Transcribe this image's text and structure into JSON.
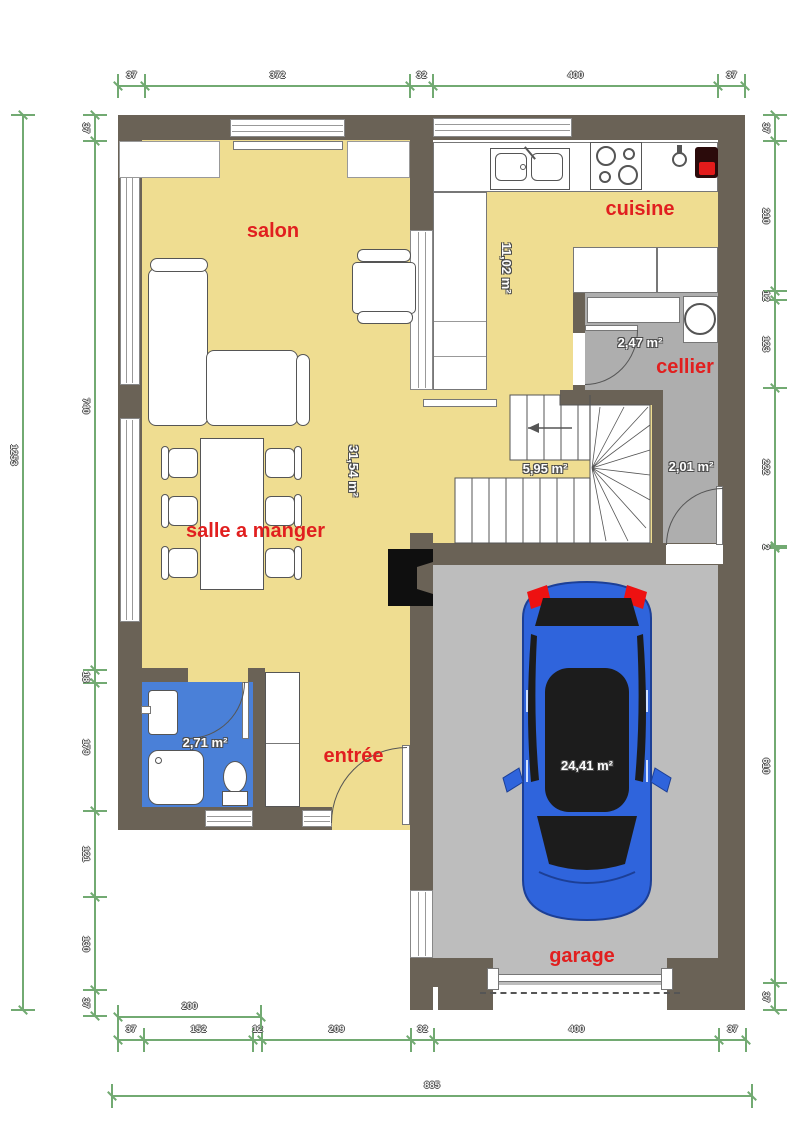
{
  "rooms": {
    "salon": "salon",
    "cuisine": "cuisine",
    "cellier": "cellier",
    "salle_a_manger": "salle a manger",
    "entree": "entrée",
    "garage": "garage"
  },
  "areas": {
    "cuisine": "11,02 m²",
    "cellier": "2,47 m²",
    "stairs": "5,95 m²",
    "hall": "2,01 m²",
    "sejour": "31,54 m²",
    "bathroom": "2,71 m²",
    "garage": "24,41 m²"
  },
  "dimensions": {
    "top": [
      "37",
      "372",
      "32",
      "400",
      "37"
    ],
    "left_overall": [
      "1253"
    ],
    "left": [
      "37",
      "740",
      "18",
      "179",
      "121",
      "130",
      "37"
    ],
    "right": [
      "37",
      "210",
      "12",
      "123",
      "222",
      "2",
      "610",
      "37"
    ],
    "bottom_200": [
      "200"
    ],
    "bottom": [
      "37",
      "152",
      "12",
      "209",
      "32",
      "400",
      "37"
    ],
    "bottom_overall": [
      "885"
    ]
  },
  "colors": {
    "wall": "#6a6256",
    "floor_yellow": "#efdd91",
    "floor_gray": "#aeaeae",
    "floor_garage": "#bdbdbd",
    "bathroom_blue": "#4a80d8",
    "car_blue": "#2f64dc",
    "label_red": "#e11f1f",
    "dimension_green": "#72aa72"
  }
}
